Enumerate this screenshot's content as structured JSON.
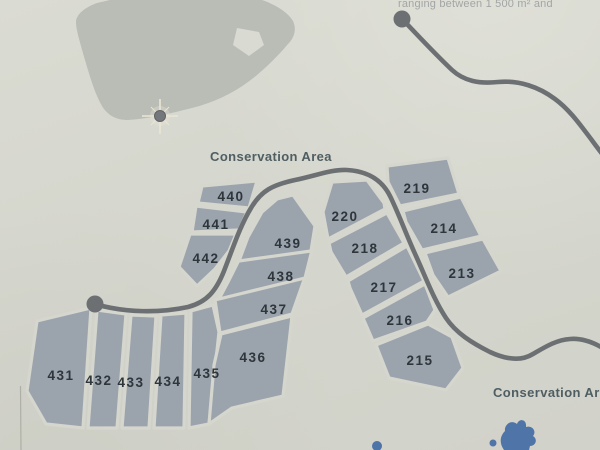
{
  "note_top_right": "ranging between 1 500 m² and",
  "labels": {
    "conservation_top": "Conservation Area",
    "conservation_bottom": "Conservation Area"
  },
  "lots": {
    "431": "431",
    "432": "432",
    "433": "433",
    "434": "434",
    "435": "435",
    "436": "436",
    "437": "437",
    "438": "438",
    "439": "439",
    "440": "440",
    "441": "441",
    "442": "442",
    "213": "213",
    "214": "214",
    "215": "215",
    "216": "216",
    "217": "217",
    "218": "218",
    "219": "219",
    "220": "220"
  },
  "icons": {
    "location_star": "location-star-icon",
    "cul_de_sac": "cul-de-sac-circle"
  },
  "colors": {
    "paper": "#d5d6cd",
    "lot_fill": "#9ba3ad",
    "road": "#6c7073",
    "map_silhouette": "#babcb6",
    "water": "#4f74a8",
    "label": "#4f5e63",
    "number": "#2e353b",
    "note": "#a2a5a6",
    "star_rays": "#eae6d4",
    "star_dot": "#74787c"
  }
}
